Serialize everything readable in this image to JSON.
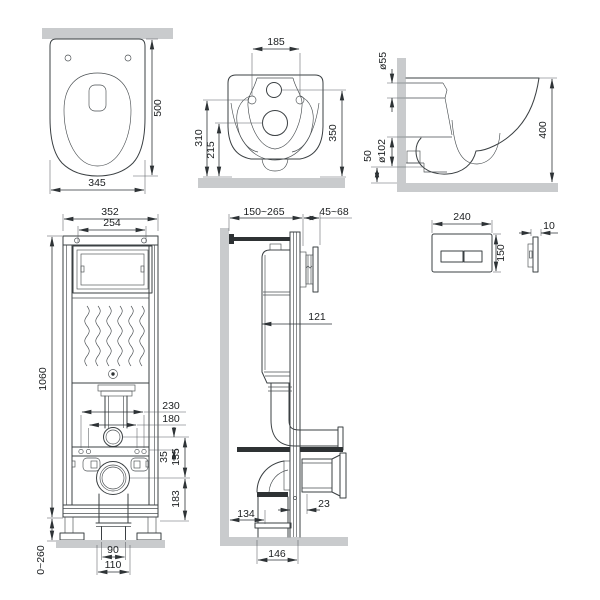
{
  "drawing": {
    "type": "technical-dimension-diagram",
    "subject": "wall-hung toilet with concealed installation frame and flush plate",
    "units": "mm",
    "colors": {
      "line": "#3b4043",
      "surface_fill": "#c9cbcd",
      "background": "#ffffff",
      "dim_text": "#1b1e20"
    },
    "views": {
      "pan_top": {
        "label": "toilet-top-view",
        "dims": {
          "depth": "500",
          "width": "345"
        }
      },
      "pan_rear": {
        "label": "toilet-rear-view",
        "dims": {
          "bolt_spacing": "185",
          "bolt_height": "310",
          "outlet_height": "215",
          "inlet_height": "350"
        }
      },
      "pan_side": {
        "label": "toilet-side-view",
        "dims": {
          "inlet_dia": "ø55",
          "outlet_dia": "ø102",
          "outlet_offset": "50",
          "depth": "400"
        }
      },
      "frame_front": {
        "label": "frame-front-view",
        "dims": {
          "width": "352",
          "panel_width": "254",
          "height": "1060",
          "bolt_span_outer": "230",
          "bolt_span_inner": "180",
          "bar_offset": "35",
          "inlet_outlet": "135",
          "outlet_base": "183",
          "leg_range": "0~260",
          "drain_width": "90",
          "collar_width": "110"
        }
      },
      "frame_side": {
        "label": "frame-side-view",
        "dims": {
          "depth_range": "150~265",
          "plate_depth": "45~68",
          "tank_depth": "121",
          "drain_offset": "134",
          "gap": "23",
          "drain_span": "146"
        }
      },
      "flush_plate": {
        "label": "flush-plate-view",
        "dims": {
          "width": "240",
          "height": "150",
          "thickness": "10"
        }
      }
    }
  }
}
